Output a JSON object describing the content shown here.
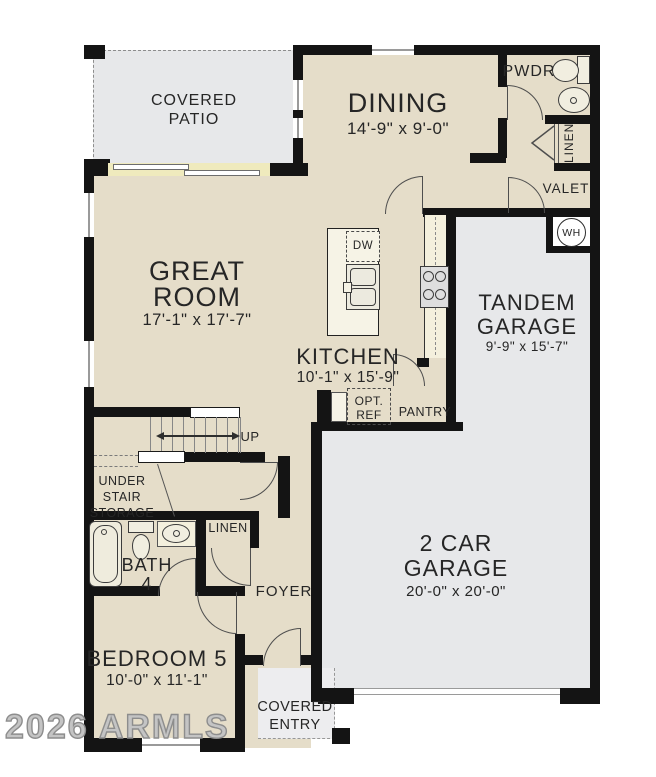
{
  "watermark": "2026 ARMLS",
  "colors": {
    "floor": "#e5ddc9",
    "patio_garage_floor": "#e7e8ea",
    "wall": "#141414",
    "sliding_door_band": "#efeabd",
    "counter": "#f4f0dd"
  },
  "rooms": {
    "covered_patio": {
      "line1": "COVERED",
      "line2": "PATIO"
    },
    "dining": {
      "name": "DINING",
      "dims": "14'-9\" x 9'-0\""
    },
    "pwdr": {
      "name": "PWDR"
    },
    "linen_upper": {
      "name": "LINEN"
    },
    "valet": {
      "name": "VALET"
    },
    "water_heater": {
      "abbr": "WH"
    },
    "great_room": {
      "line1": "GREAT",
      "line2": "ROOM",
      "dims": "17'-1\" x 17'-7\""
    },
    "kitchen": {
      "name": "KITCHEN",
      "dims": "10'-1\" x 15'-9\"",
      "dishwasher": "DW",
      "opt_ref_line1": "OPT.",
      "opt_ref_line2": "REF",
      "pantry": "PANTRY"
    },
    "tandem_garage": {
      "line1": "TANDEM",
      "line2": "GARAGE",
      "dims": "9'-9\" x 15'-7\""
    },
    "stairs": {
      "up": "UP",
      "storage_line1": "UNDER",
      "storage_line2": "STAIR",
      "storage_line3": "STORAGE"
    },
    "bath4": {
      "line1": "BATH",
      "line2": "4"
    },
    "linen_hall": {
      "name": "LINEN"
    },
    "foyer": {
      "name": "FOYER"
    },
    "bedroom5": {
      "name": "BEDROOM 5",
      "dims": "10'-0\" x 11'-1\""
    },
    "covered_entry": {
      "line1": "COVERED",
      "line2": "ENTRY"
    },
    "garage_2car": {
      "line1": "2 CAR",
      "line2": "GARAGE",
      "dims": "20'-0\" x 20'-0\""
    }
  }
}
